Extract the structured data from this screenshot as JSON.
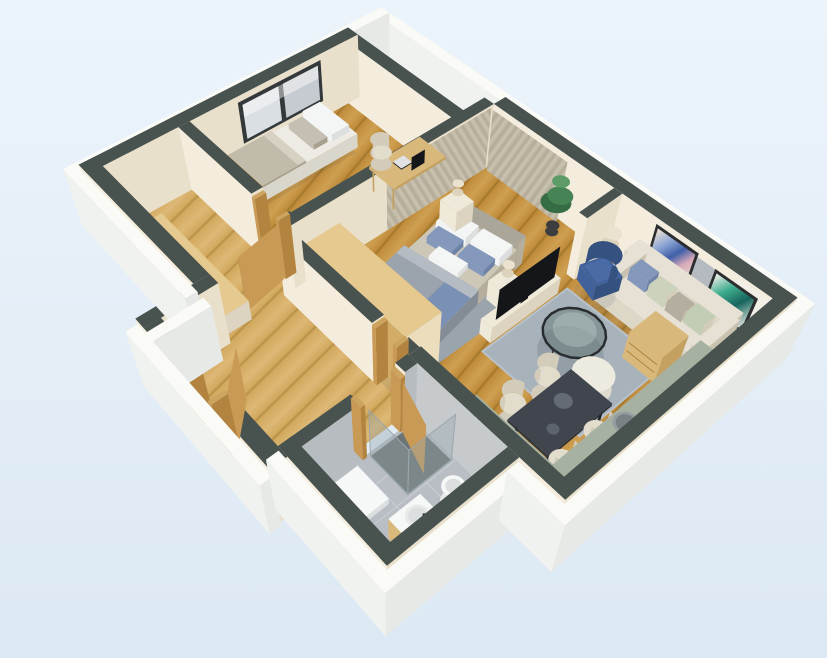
{
  "scene": {
    "type": "3d-floor-plan",
    "description": "3D perspective floor plan of a one-bedroom apartment with living room, kitchen, two bedrooms, bathroom and hallway",
    "rooms": [
      {
        "name": "small-bedroom",
        "furniture": [
          "window",
          "single-bed",
          "pillows",
          "blanket",
          "desk",
          "laptop",
          "monitor",
          "desk-chair"
        ]
      },
      {
        "name": "master-bedroom",
        "furniture": [
          "curtains",
          "double-bed",
          "headboard",
          "duvet",
          "pillows",
          "nightstand",
          "table-lamp",
          "tv-console",
          "tv",
          "wardrobe",
          "area-rug"
        ]
      },
      {
        "name": "living-room",
        "furniture": [
          "sofa",
          "throw-pillows",
          "wall-art-blue",
          "wall-art-teal",
          "coffee-table",
          "pouf",
          "rug",
          "armchair",
          "floor-lamp",
          "plant",
          "dining-table",
          "dining-chairs"
        ]
      },
      {
        "name": "kitchen",
        "furniture": [
          "fridge",
          "upper-cabinets",
          "counter",
          "sink",
          "cooktop",
          "drawer-unit"
        ]
      },
      {
        "name": "bathroom",
        "furniture": [
          "shower",
          "shower-glass",
          "shower-tray",
          "toilet",
          "vanity-sink",
          "faucet",
          "door"
        ]
      },
      {
        "name": "hallway",
        "furniture": [
          "entrance-door",
          "door-frames",
          "sideboard",
          "interior-door"
        ]
      }
    ]
  },
  "palette": {
    "bgTop": "#ecf4fb",
    "bgBottom": "#dce8f3",
    "wallTop": "#48524f",
    "wallTopLight": "#515b58",
    "wallFace": "#f4edde",
    "wallFaceE": "#e9e0cb",
    "outerTop": "#fafaf6",
    "outerS": "#f0f2ef",
    "outerE": "#e6e9e6",
    "woodDark": "#a0762b",
    "wood": "#c08c3c",
    "woodLight": "#cfa052",
    "hallWoodDark": "#b68f45",
    "hallWood": "#d2a95f",
    "hallWoodLight": "#ddb876",
    "bathFloor": "#b8bec4",
    "bathGrid": "#c9cfd4",
    "tileWall": "#c6cacd",
    "tileWallE": "#b7bcc0",
    "winFrame": "#33383b",
    "winGlass1": "#c6cbd1",
    "winGlass2": "#dadfe3",
    "curtain1": "#cbc4b2",
    "curtain2": "#b2aa96",
    "rug": "#a8b2bb",
    "rugEdge": "#b9c2ca",
    "rugBed": "#9aa4ad",
    "mattress": "#edebe3",
    "mattressE": "#d9d6cb",
    "pillowW": "#f4f5f5",
    "pillowWE": "#dcdedf",
    "pillowGray": "#c4bfb2",
    "blanket": "#c1bbab",
    "blanketE": "#a89f8d",
    "blanketFold": "#d6d1c3",
    "bedBase": "#cdc7b8",
    "bedBaseE": "#b5ae9d",
    "headboard": "#aaa69a",
    "duvet": "#9ba3ad",
    "duvetE": "#848c96",
    "duvetS": "#8d95a0",
    "duvetLight": "#b4bbc3",
    "pillowBlue": "#8398bb",
    "pillowBlueE": "#6d82a6",
    "throwBlue": "#7a90b5",
    "nightstand": "#efe9da",
    "nightstandE": "#dcd4c0",
    "lampStem": "#e9e6dd",
    "lampShade": "#ddd3bc",
    "lampShadeT": "#eae2cf",
    "tv": "#141619",
    "deskWood": "#d9b87b",
    "deskWoodE": "#c4a160",
    "woodSeam": "#a8803d",
    "chairSide": "#d3ccba",
    "chairTop": "#e2dccc",
    "sofa": "#ddd7c8",
    "sofaE": "#c9c2b0",
    "sofaT": "#e6e1d4",
    "sofaShade": "#c2bbaa",
    "pillowSage": "#ccd2bc",
    "pillowTaupe": "#b3aea0",
    "pillowSage2": "#c3ccb4",
    "armchair": "#40619a",
    "armchairBack": "#35517f",
    "armchairCushion": "#4a6ba6",
    "glassFill": "rgba(96,116,112,0.45)",
    "glassHi": "rgba(210,224,222,0.30)",
    "glassRim": "#2a2d2f",
    "poufS": "#dfdbce",
    "poufT": "#edeadf",
    "marble": "#41464e",
    "marbleS": "#31353b",
    "marbleE": "#2a2d33",
    "dark": "#232527",
    "frame": "#2b2d2f",
    "artMatBlue": "#e5dcd2",
    "artMatTeal": "#e4eae3",
    "fridge": "#a3aab0",
    "fridgeE": "#8f979d",
    "fridgeT": "#b4bac0",
    "fridgeSeam": "#7f868c",
    "cabinet": "#f1efe6",
    "cabinetE": "#e0ddd1",
    "cabSeam": "#d8d4c6",
    "terrazzo": "#a7b1a1",
    "terrazzoE": "#929c8d",
    "counterFace": "#eae5d6",
    "cooktop": "#242d45",
    "ring": "#cdd5e2",
    "sinkRim": "#969da1",
    "sinkBasin": "#7b8286",
    "white": "#f6f7f7",
    "whiteS": "#e8eaea",
    "whiteE": "#dcdfdf",
    "showerFloor": "#6d7476",
    "glassWall": "rgba(150,165,170,0.38)",
    "glassEdge": "#9aa6a9",
    "doorWood": "#c89a55",
    "doorWoodE": "#b2843f",
    "doorFrame": "#cda45f",
    "plantDark": "#366c43",
    "plant": "#478455",
    "plantLight": "#5d9c67",
    "pot": "#3b3d3f",
    "shadow": "rgba(45,55,65,0.10)",
    "shadowDeep": "rgba(45,55,65,0.16)"
  }
}
